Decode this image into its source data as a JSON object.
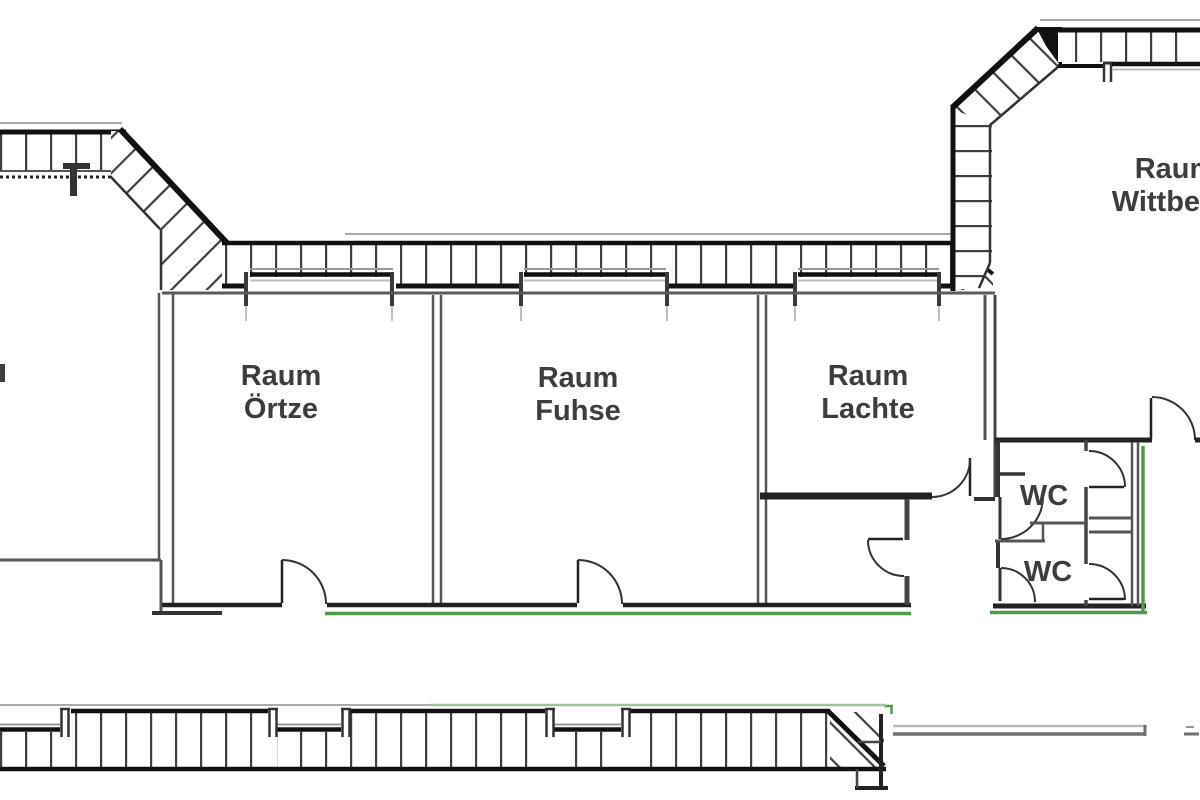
{
  "plan": {
    "type": "architectural-floor-plan",
    "rooms": [
      {
        "id": "oertze",
        "line1": "Raum",
        "line2": "Örtze"
      },
      {
        "id": "fuhse",
        "line1": "Raum",
        "line2": "Fuhse"
      },
      {
        "id": "lachte",
        "line1": "Raum",
        "line2": "Lachte"
      },
      {
        "id": "wittbeck",
        "line1": "Raum",
        "line2": "Wittbeck"
      },
      {
        "id": "wc-upper",
        "label": "WC"
      },
      {
        "id": "wc-lower",
        "label": "WC"
      }
    ]
  },
  "colors": {
    "wall_dark": "#1f1f1f",
    "wall_mid": "#555555",
    "hatch": "#3f3f3f",
    "escape_route_green": "#4e9b4e",
    "light_green": "#9cc49c",
    "label_text": "#3d3d3d"
  }
}
